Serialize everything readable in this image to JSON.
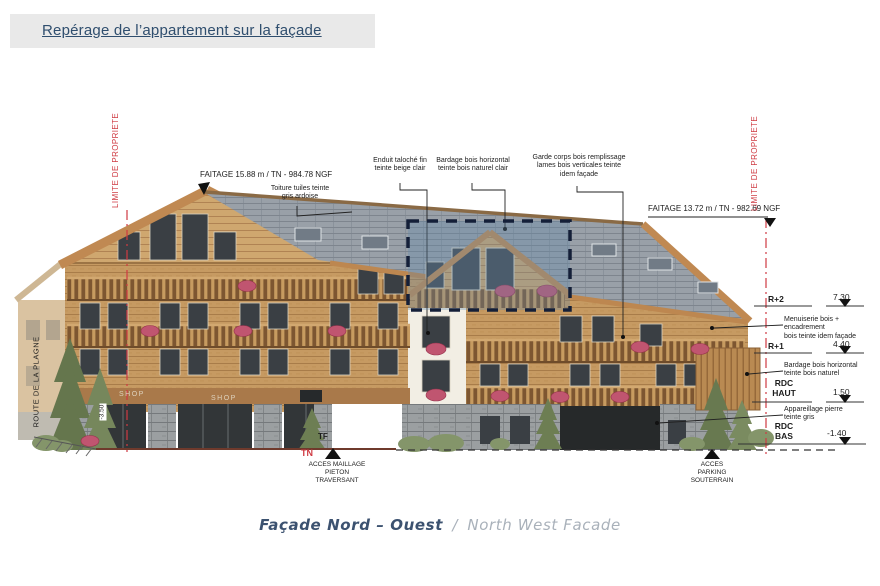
{
  "header": {
    "title": "Repérage de l’appartement sur la façade"
  },
  "annotations": {
    "faitage_left": "FAITAGE 15.88 m / TN - 984.78 NGF",
    "toiture": "Toiture tuiles teinte\ngris ardoise",
    "enduit": "Enduit taloché fin\nteinte beige clair",
    "bardage_clair": "Bardage bois horizontal\nteinte bois naturel clair",
    "garde_corps": "Garde corps bois remplissage\nlames bois verticales teinte\nidem façade",
    "faitage_right": "FAITAGE 13.72 m / TN - 982.69 NGF",
    "menuiserie": "Menuiserie bois + encadrement\nbois teinte idem façade",
    "bardage_naturel": "Bardage bois horizontal\nteinte bois naturel",
    "appareillage": "Appareillage pierre\nteinte gris"
  },
  "levels": [
    {
      "name": "R+2",
      "value": "7.30"
    },
    {
      "name": "R+1",
      "value": "4.40"
    },
    {
      "name": "RDC\nHAUT",
      "value": "1.50"
    },
    {
      "name": "RDC\nBAS",
      "value": "-1.40"
    }
  ],
  "site_labels": {
    "route": "ROUTE DE LA PLAGNE",
    "limite_left": "LIMITE DE PROPRIETE",
    "limite_right": "LIMITE DE PROPRIETE",
    "level_minus": "-3.50",
    "tf": "TF",
    "tn": "TN",
    "acces_pieton": "ACCES MAILLAGE\nPIETON\nTRAVERSANT",
    "acces_parking": "ACCES\nPARKING\nSOUTERRAIN"
  },
  "shops": {
    "shop1": "SHOP",
    "shop2": "SHOP"
  },
  "caption": {
    "fr": "Façade Nord – Ouest",
    "sep": "/",
    "en": "North West Facade"
  },
  "colors": {
    "title_text": "#2f4e6e",
    "limite_red": "#cf3a42",
    "highlight_fill": "#6088aa",
    "highlight_border": "#141f38",
    "roof_slate": "#99a0a8",
    "wood_facade": "#c69a62",
    "stone": "#9b9fa1",
    "caption_fr": "#3c5270",
    "caption_en": "#a9b1ba"
  }
}
